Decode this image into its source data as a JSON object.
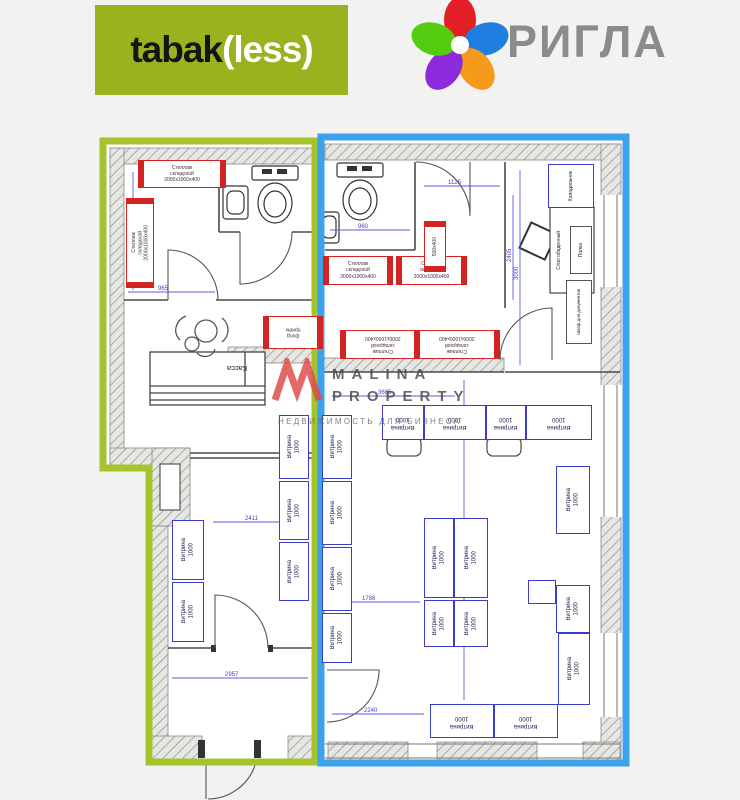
{
  "header": {
    "tabakless": {
      "part_black": "tabak",
      "part_white": "(less)",
      "bg_color": "#9bb11e"
    },
    "rigla": {
      "brand": "РИГЛА"
    }
  },
  "watermark": {
    "title_line1": "MALINA",
    "title_line2": "PROPERTY",
    "subtitle": "НЕДВИЖИМОСТЬ ДЛЯ БИЗНЕСА"
  },
  "plan": {
    "section_left_color": "#a5c32d",
    "section_right_color": "#3da2ec",
    "labels": {
      "vitrina": "Витрина",
      "vitrina_size": "1000",
      "shelf_l1": "Стеллаж",
      "shelf_l2": "складской",
      "shelf_l3": "2000х1000х400",
      "kassa": "Касса",
      "fund_l1": "фонд",
      "fund_l2": "прием",
      "small_table": "500х400",
      "dining_table": "Стол обеденный",
      "shelf_small": "Полка",
      "doc_cabinet": "Шкаф для документов",
      "fridge": "Холодильник"
    },
    "dims": [
      "965",
      "1370",
      "2411",
      "2957",
      "960",
      "3000",
      "1125",
      "3940",
      "1786",
      "2240",
      "2405",
      "3685"
    ]
  }
}
